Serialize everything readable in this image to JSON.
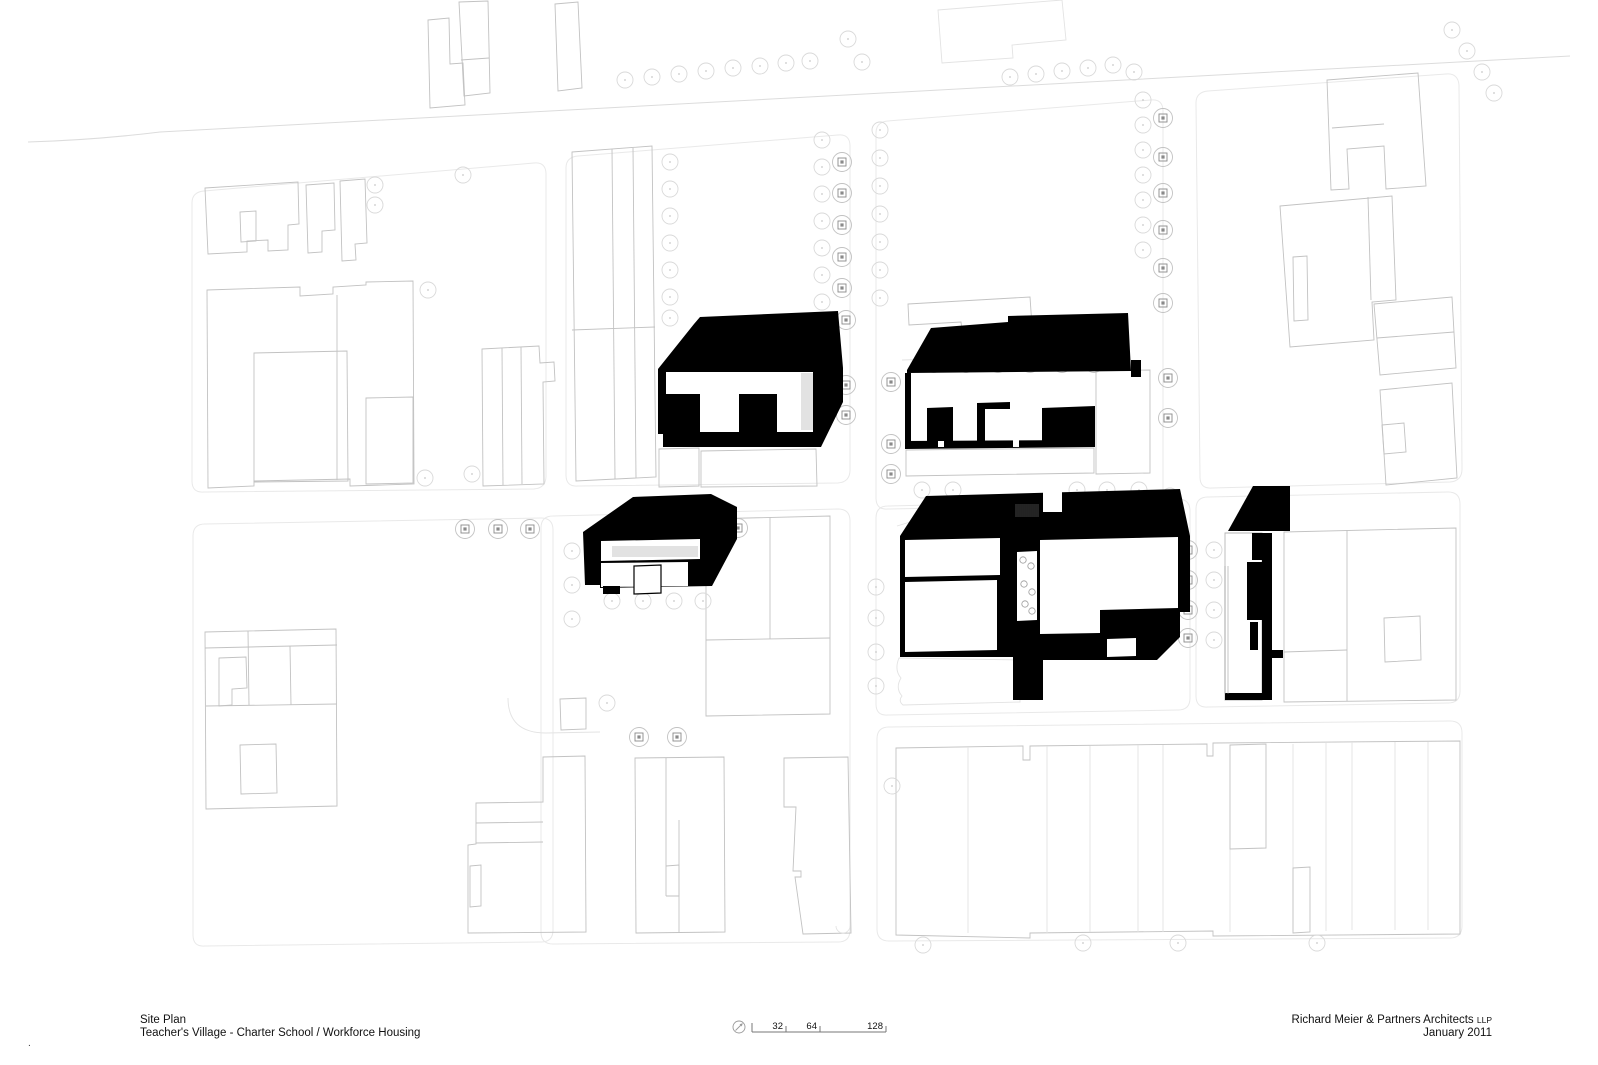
{
  "title_block": {
    "line1": "Site Plan",
    "line2": "Teacher's Village - Charter School / Workforce Housing"
  },
  "credits": {
    "firm": "Richard Meier & Partners Architects",
    "firm_suffix": "LLP",
    "date": "January 2011"
  },
  "corner_mark": ".",
  "scale_bar": {
    "labels": [
      "32",
      "64",
      "128"
    ],
    "label_x": [
      783,
      817,
      883
    ],
    "ticks_x": [
      752,
      786,
      820,
      886
    ],
    "bar": {
      "x1": 752,
      "x2": 886,
      "y": 1032
    },
    "north": {
      "cx": 739,
      "cy": 1027,
      "r": 6
    }
  },
  "colors": {
    "building_fill": "#000000",
    "context_line": "#c2c2c2",
    "faint_line": "#e3e3e3",
    "block_line": "#e9e9e9",
    "street_line": "#dcdcdc",
    "tree_line": "#d9d9d9",
    "project_tree_line": "#8a8a8a",
    "text": "#111111"
  },
  "drawing": {
    "width": 1598,
    "height": 1065,
    "streets": [
      {
        "name": "top-road",
        "d": "M28 142 Q95 140 160 132 L1570 56"
      }
    ],
    "blocks": [
      {
        "name": "city-block-nw",
        "d": "M204 191 L534 163 Q546 162 546 174 L546 476 Q546 488 534 489 L204 492 Q192 493 192 481 L192 203 Q192 192 204 191 Z"
      },
      {
        "name": "city-block-n",
        "d": "M578 156 L838 135 Q850 134 850 146 L850 470 Q850 482 838 483 L578 486 Q566 487 566 475 L566 168 Q566 157 578 156 Z"
      },
      {
        "name": "city-block-ne-project",
        "d": "M888 121 L1151 100 Q1163 99 1163 111 L1163 491 Q1163 503 1151 504 L888 509 Q876 510 876 498 L876 133 Q876 122 888 121 Z"
      },
      {
        "name": "city-block-far-ne",
        "d": "M1208 91 L1446 74 Q1458 73 1459 85 L1462 469 Q1462 481 1450 482 L1212 488 Q1200 489 1200 477 L1196 103 Q1196 92 1208 91 Z"
      },
      {
        "name": "city-block-w",
        "d": "M205 524 L541 518 Q553 518 553 530 L553 930 Q553 942 541 942 L205 946 Q193 947 193 935 L193 536 Q193 524 205 524 Z"
      },
      {
        "name": "city-block-center",
        "d": "M553 516 L838 509 Q850 509 850 521 L850 930 Q850 942 838 942 L553 944 Q541 944 541 932 L541 528 Q541 516 553 516 Z"
      },
      {
        "name": "city-block-project-south",
        "d": "M888 506 L1178 499 Q1190 499 1190 511 L1190 698 Q1190 710 1178 710 L888 715 Q876 716 876 704 L876 518 Q876 506 888 506 Z"
      },
      {
        "name": "city-block-e",
        "d": "M1208 497 L1448 492 Q1460 492 1460 504 L1460 691 Q1460 703 1448 703 L1208 707 Q1196 708 1196 696 L1196 509 Q1196 497 1208 497 Z"
      },
      {
        "name": "city-block-se",
        "d": "M889 727 L1450 721 Q1462 721 1462 733 L1462 926 Q1462 938 1450 938 L889 941 Q877 941 877 929 L877 739 Q877 727 889 727 Z"
      }
    ],
    "context": [
      {
        "name": "context-tower-a",
        "d": "M428 20 L449 18 L450 64 L463 63 L465 105 L430 108 Z"
      },
      {
        "name": "context-tower-a2",
        "d": "M459 2 L488 1 L490 93 L464 96 Z"
      },
      {
        "name": "context-tower-a2-divider",
        "d": "M461 60 L489 58"
      },
      {
        "name": "context-tower-b",
        "d": "M555 4 L578 2 L582 88 L558 91 Z"
      },
      {
        "name": "context-lot-north",
        "d": "M938 10 L1062 0 L1066 40 L1012 45 L1013 58 L942 63 Z",
        "faint": true
      },
      {
        "name": "context-nw-1",
        "d": "M205 188 L298 182 L299 224 L288 225 L288 250 L268 251 L268 240 L247 241 L247 252 L208 254 Z"
      },
      {
        "name": "context-nw-1-court",
        "d": "M240 212 L256 211 L256 241 L241 242 Z"
      },
      {
        "name": "context-nw-2",
        "d": "M306 185 L334 183 L335 230 L322 231 L322 252 L308 253 Z"
      },
      {
        "name": "context-nw-3",
        "d": "M340 181 L365 179 L367 243 L355 244 L356 260 L342 261 Z"
      },
      {
        "name": "context-nw-4",
        "d": "M207 290 L300 287 L300 296 L333 294 L333 287 L366 285 L366 282 L413 281 L414 484 L350 486 L350 479 L254 481 L254 486 L208 488 Z"
      },
      {
        "name": "context-nw-4-court",
        "d": "M254 353 L347 351 L348 481 L254 482 Z"
      },
      {
        "name": "context-nw-4-divider",
        "d": "M337 295 L337 480"
      },
      {
        "name": "context-nw-4-inner",
        "d": "M366 398 L413 397 L413 483 L366 484 Z"
      },
      {
        "name": "context-nw-5",
        "d": "M482 349 L539 346 L540 363 L554 362 L555 381 L543 382 L544 484 L483 486 Z"
      },
      {
        "name": "context-nw-5-div1",
        "d": "M502 348 L503 485"
      },
      {
        "name": "context-nw-5-div2",
        "d": "M521 347 L522 484"
      },
      {
        "name": "context-strips-n",
        "d": "M572 152 L652 146 L656 477 L576 481 Z"
      },
      {
        "name": "context-strips-n-div1",
        "d": "M612 149 L615 479"
      },
      {
        "name": "context-strips-n-div2",
        "d": "M633 148 L636 478"
      },
      {
        "name": "context-strips-n-div3",
        "d": "M572 330 L655 327"
      },
      {
        "name": "context-ne-1",
        "d": "M1327 80 L1418 73 L1426 186 L1386 189 L1384 146 L1347 149 L1349 189 L1331 190 Z"
      },
      {
        "name": "context-ne-1-inner",
        "d": "M1332 128 L1384 124"
      },
      {
        "name": "context-ne-2",
        "d": "M1280 206 L1392 196 L1396 300 L1372 302 L1374 340 L1290 347 Z"
      },
      {
        "name": "context-ne-2-strip",
        "d": "M1368 197 L1371 300"
      },
      {
        "name": "context-ne-2-inner",
        "d": "M1293 257 L1307 256 L1308 320 L1294 321 Z"
      },
      {
        "name": "context-ne-3",
        "d": "M1374 304 L1452 297 L1456 368 L1380 375 Z"
      },
      {
        "name": "context-ne-3-divider",
        "d": "M1377 338 L1454 332"
      },
      {
        "name": "context-ne-4",
        "d": "M1380 390 L1452 383 L1457 478 L1386 485 Z"
      },
      {
        "name": "context-ne-4-inner",
        "d": "M1382 425 L1404 423 L1406 452 L1384 454 Z"
      },
      {
        "name": "context-w-1",
        "d": "M205 632 L336 629 L337 806 L206 809 Z"
      },
      {
        "name": "context-w-1-h1",
        "d": "M205 648 L337 645"
      },
      {
        "name": "context-w-1-v1",
        "d": "M248 631 L249 705"
      },
      {
        "name": "context-w-1-inner1",
        "d": "M219 658 L246 657 L247 688 L232 689 L232 705 L219 706 Z"
      },
      {
        "name": "context-w-1-h2",
        "d": "M206 706 L337 704"
      },
      {
        "name": "context-w-1-v2",
        "d": "M290 646 L291 705"
      },
      {
        "name": "context-w-1-inner2",
        "d": "M240 745 L276 744 L277 793 L241 794 Z"
      },
      {
        "name": "context-center-lot",
        "d": "M706 519 L830 516 L830 714 L706 716 Z"
      },
      {
        "name": "context-center-lot-h",
        "d": "M706 640 L830 638"
      },
      {
        "name": "context-center-lot-v",
        "d": "M770 517 L770 639"
      },
      {
        "name": "context-center-small",
        "d": "M560 699 L586 698 L586 729 L561 730 Z"
      },
      {
        "name": "context-center-curve",
        "d": "M508 698 Q508 733 546 733 L600 732",
        "faint": true
      },
      {
        "name": "context-rowhouse-1",
        "d": "M543 757 L585 756 L586 932 L468 933 L468 845 L476 844 L476 803 L543 802 Z"
      },
      {
        "name": "context-rowhouse-1-h1",
        "d": "M476 823 L543 822"
      },
      {
        "name": "context-rowhouse-1-h2",
        "d": "M476 843 L543 842"
      },
      {
        "name": "context-rowhouse-1-inner",
        "d": "M470 866 L481 865 L481 906 L470 907 Z"
      },
      {
        "name": "context-rowhouse-2",
        "d": "M635 758 L724 757 L725 932 L636 933 Z"
      },
      {
        "name": "context-rowhouse-2-v1",
        "d": "M666 758 L666 896"
      },
      {
        "name": "context-rowhouse-2-step",
        "d": "M666 866 L679 865 L679 896 L666 896"
      },
      {
        "name": "context-rowhouse-2-v2",
        "d": "M679 820 L679 932"
      },
      {
        "name": "context-rowhouse-3",
        "d": "M784 758 L848 757 L851 933 L803 934 L795 877 L801 877 L801 871 L793 871 L796 807 L784 807 Z"
      },
      {
        "name": "context-rowhouse-3-arc",
        "d": "M836 926 A7 7 0 1 0 850 926",
        "faint": true
      },
      {
        "name": "context-se-rowhouses",
        "d": "M896 748 L1023 746 L1023 760 L1030 760 L1030 746 L1207 744 L1207 756 L1213 756 L1213 743 L1460 741 L1460 934 L1213 936 L1213 931 L1030 933 L1030 938 L896 935 Z"
      },
      {
        "name": "context-se-lot-lines",
        "d": "M968 747 L968 933 M1047 746 L1047 933 M1090 746 L1090 932 M1138 745 L1138 932 M1163 745 L1163 932 M1230 848 L1230 932 M1293 744 L1293 931 M1326 743 L1326 931 M1352 742 L1352 930 M1395 742 L1395 930 M1428 742 L1428 930",
        "faint": true
      },
      {
        "name": "context-se-inner-rect",
        "d": "M1230 745 L1266 744 L1266 848 L1230 849 Z"
      },
      {
        "name": "context-se-inner-rect2",
        "d": "M1293 868 L1310 867 L1310 932 L1293 933 Z"
      },
      {
        "name": "context-e-1",
        "d": "M1284 532 L1456 528 L1456 700 L1284 702 Z"
      },
      {
        "name": "context-e-1-v",
        "d": "M1347 530 L1347 701"
      },
      {
        "name": "context-e-1-inner",
        "d": "M1384 618 L1420 616 L1421 660 L1385 662 Z"
      },
      {
        "name": "context-e-1-h",
        "d": "M1284 652 L1347 650"
      },
      {
        "name": "context-plate-b1-left",
        "d": "M659 449 L699 448 L699 486 L659 487 Z"
      },
      {
        "name": "context-plate-b1-right",
        "d": "M701 451 L816 449 L817 486 L701 487 Z"
      },
      {
        "name": "context-plate-b2-top",
        "d": "M908 304 L1030 297 L1032 326 L962 330 L961 322 L909 325 Z"
      },
      {
        "name": "context-plate-b2-bottom",
        "d": "M906 450 L1094 448 L1094 473 L906 476 Z"
      },
      {
        "name": "context-plate-b2-right",
        "d": "M1096 371 L1150 370 L1150 473 L1096 474 Z"
      },
      {
        "name": "context-lot-wavy",
        "d": "M899 658 Q894 670 901 678 Q895 688 902 696 Q898 701 903 705 L1020 702 L1020 660 Z",
        "faint": true
      },
      {
        "name": "context-b5-inner",
        "d": "M1232 578 L1247 577 L1247 670 L1232 671 Z"
      },
      {
        "name": "streetscape-scallop-1",
        "d": "M897 526 L930 516 L965 520 L1000 516 L1035 520 L1070 516 L1105 520 L1140 516 L1185 519",
        "faint": true
      },
      {
        "name": "streetscape-scallop-2",
        "d": "M902 360 L1130 352",
        "faint": true
      }
    ],
    "buildings": [
      {
        "name": "proposed-building-1",
        "black_evenodd": "M658 369 L694 324 L700 317 L838 311 L843 368 L843 402 L821 447 L663 447 L663 434 L658 434 Z M666 372 L813 372 L813 432 L777 432 L777 394 L739 394 L739 432 L700 432 L700 394 L666 394 Z",
        "hatch": [
          {
            "x": 802,
            "y": 373,
            "w": 11,
            "h": 57,
            "gap": 2
          }
        ]
      },
      {
        "name": "proposed-building-2",
        "black": [
          "M907 370 L931 328 L1008 322 L1008 316 L1128 313 L1131 371 L907 373 Z",
          "M1131 360 L1141 360 L1141 377 L1131 377 Z",
          "M905 373 L911 373 L911 448 L905 448 Z",
          "M927 408 L953 407 L953 441 L927 441 Z",
          "M977 403 L1010 402 L1010 409 L985 409 L985 441 L977 441 Z",
          "M1042 408 L1095 406 L1095 441 L1042 441 Z",
          "M905 441 L1095 440 L1095 447 L905 449 Z"
        ],
        "white_over": [
          {
            "d": "M938 441 L944 441 L944 447 L938 447 Z"
          },
          {
            "d": "M1013 440 L1019 440 L1019 447 L1013 447 Z"
          }
        ]
      },
      {
        "name": "proposed-building-3",
        "black_evenodd": "M583 532 L633 497 L711 494 L737 507 L737 539 L712 586 L600 588 L600 585 L585 585 Z M601 541 L700 539 L700 559 L601 561 Z M601 563 L688 562 L688 586 L601 587 Z",
        "black": [
          "M603 586 L620 586 L620 594 L603 594 Z"
        ],
        "white_over": [
          {
            "d": "M634 566 L661 565 L661 593 L634 594 Z",
            "stroke": true
          }
        ],
        "hatch": [
          {
            "x": 613,
            "y": 546,
            "w": 85,
            "h": 11,
            "gap": 2
          }
        ]
      },
      {
        "name": "proposed-building-4",
        "black_evenodd": "M900 536 L926 496 L1180 489 L1190 536 L1190 612 L1180 612 L1180 637 L1157 660 L1043 660 L1043 700 L1013 700 L1013 657 L900 657 Z M905 540 L1000 538 L1000 575 L905 577 Z M905 582 L997 580 L997 650 L905 652 Z M1017 552 L1037 551 L1037 620 L1017 621 Z M1040 540 L1178 537 L1178 608 L1100 610 L1100 633 L1040 634 Z M1107 639 L1136 638 L1136 656 L1107 657 Z",
        "white_over": [
          {
            "d": "M1043 489 L1062 489 L1062 512 L1043 512 Z"
          }
        ],
        "hatch": [
          {
            "x": 1016,
            "y": 504,
            "w": 23,
            "h": 13,
            "gap": 2
          }
        ],
        "circles": {
          "r": 3.2,
          "pts": [
            [
              1023,
              560
            ],
            [
              1031,
              566
            ],
            [
              1024,
              584
            ],
            [
              1032,
              592
            ],
            [
              1025,
              604
            ],
            [
              1032,
              611
            ]
          ]
        }
      },
      {
        "name": "proposed-building-5",
        "white_under": [
          {
            "d": "M1225 533 L1262 533 L1262 700 L1225 700 Z"
          }
        ],
        "black": [
          "M1253 486 L1290 486 L1290 531 L1228 531 Z",
          "M1262 533 L1272 533 L1272 700 L1262 700 Z",
          "M1252 533 L1262 533 L1262 560 L1252 560 Z",
          "M1247 562 L1262 562 L1262 620 L1247 620 Z",
          "M1250 622 L1258 622 L1258 650 L1250 650 Z",
          "M1225 693 L1272 693 L1272 700 L1225 700 Z",
          "M1272 650 L1283 650 L1283 658 L1272 658 Z"
        ],
        "hatch": [
          {
            "x": 1225,
            "y": 566,
            "w": 4,
            "h": 128,
            "gap": 3
          }
        ]
      }
    ],
    "street_trees": [
      [
        625,
        80
      ],
      [
        652,
        77
      ],
      [
        679,
        74
      ],
      [
        706,
        71
      ],
      [
        733,
        68
      ],
      [
        760,
        66
      ],
      [
        786,
        63
      ],
      [
        810,
        61
      ],
      [
        848,
        39
      ],
      [
        862,
        62
      ],
      [
        1010,
        77
      ],
      [
        1036,
        74
      ],
      [
        1062,
        71
      ],
      [
        1088,
        68
      ],
      [
        1113,
        65
      ],
      [
        1134,
        72
      ],
      [
        1452,
        30
      ],
      [
        1467,
        51
      ],
      [
        1482,
        72
      ],
      [
        1494,
        93
      ],
      [
        670,
        162
      ],
      [
        670,
        189
      ],
      [
        670,
        216
      ],
      [
        670,
        243
      ],
      [
        670,
        270
      ],
      [
        670,
        297
      ],
      [
        670,
        318
      ],
      [
        822,
        140
      ],
      [
        822,
        167
      ],
      [
        822,
        194
      ],
      [
        822,
        221
      ],
      [
        822,
        248
      ],
      [
        822,
        275
      ],
      [
        822,
        302
      ],
      [
        880,
        130
      ],
      [
        880,
        158
      ],
      [
        880,
        186
      ],
      [
        880,
        214
      ],
      [
        880,
        242
      ],
      [
        880,
        270
      ],
      [
        880,
        298
      ],
      [
        1143,
        100
      ],
      [
        1143,
        125
      ],
      [
        1143,
        150
      ],
      [
        1143,
        175
      ],
      [
        1143,
        200
      ],
      [
        1143,
        225
      ],
      [
        1143,
        250
      ],
      [
        375,
        185
      ],
      [
        375,
        205
      ],
      [
        463,
        175
      ],
      [
        428,
        290
      ],
      [
        425,
        478
      ],
      [
        472,
        474
      ],
      [
        572,
        551
      ],
      [
        572,
        585
      ],
      [
        572,
        619
      ],
      [
        612,
        601
      ],
      [
        643,
        601
      ],
      [
        674,
        601
      ],
      [
        703,
        601
      ],
      [
        922,
        490
      ],
      [
        953,
        490
      ],
      [
        1077,
        490
      ],
      [
        1107,
        490
      ],
      [
        1139,
        490
      ],
      [
        1170,
        496
      ],
      [
        876,
        587
      ],
      [
        876,
        618
      ],
      [
        876,
        652
      ],
      [
        876,
        686
      ],
      [
        1214,
        550
      ],
      [
        1214,
        580
      ],
      [
        1214,
        610
      ],
      [
        1214,
        640
      ],
      [
        923,
        945
      ],
      [
        1083,
        943
      ],
      [
        1178,
        943
      ],
      [
        1317,
        943
      ],
      [
        892,
        786
      ],
      [
        607,
        703
      ]
    ],
    "project_trees": [
      [
        690,
        362
      ],
      [
        720,
        362
      ],
      [
        751,
        362
      ],
      [
        783,
        362
      ],
      [
        846,
        320
      ],
      [
        846,
        385
      ],
      [
        846,
        415
      ],
      [
        934,
        363
      ],
      [
        966,
        363
      ],
      [
        998,
        363
      ],
      [
        1030,
        363
      ],
      [
        1062,
        363
      ],
      [
        1094,
        363
      ],
      [
        891,
        382
      ],
      [
        891,
        444
      ],
      [
        891,
        474
      ],
      [
        1163,
        118
      ],
      [
        1163,
        157
      ],
      [
        1163,
        193
      ],
      [
        1163,
        230
      ],
      [
        1163,
        268
      ],
      [
        1163,
        303
      ],
      [
        1168,
        378
      ],
      [
        1168,
        418
      ],
      [
        842,
        162
      ],
      [
        842,
        193
      ],
      [
        842,
        225
      ],
      [
        842,
        257
      ],
      [
        842,
        288
      ],
      [
        611,
        528
      ],
      [
        642,
        528
      ],
      [
        673,
        528
      ],
      [
        707,
        528
      ],
      [
        738,
        528
      ],
      [
        465,
        529
      ],
      [
        498,
        529
      ],
      [
        530,
        529
      ],
      [
        948,
        528
      ],
      [
        980,
        528
      ],
      [
        1011,
        528
      ],
      [
        1043,
        528
      ],
      [
        1076,
        528
      ],
      [
        1107,
        528
      ],
      [
        1139,
        528
      ],
      [
        1188,
        550
      ],
      [
        1188,
        580
      ],
      [
        1188,
        610
      ],
      [
        1188,
        638
      ],
      [
        639,
        737
      ],
      [
        677,
        737
      ]
    ]
  }
}
